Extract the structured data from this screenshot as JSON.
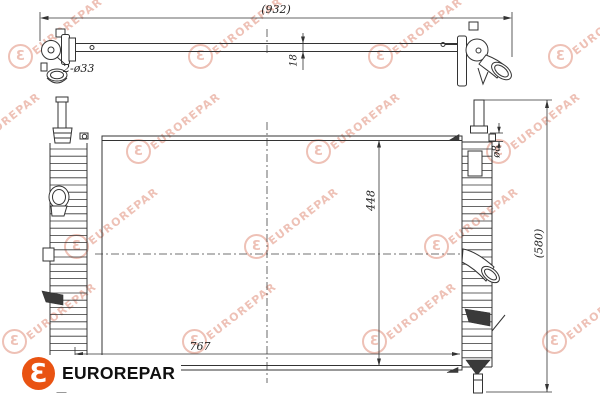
{
  "drawing": {
    "title": "radiator-technical-drawing",
    "line_color": "#333333",
    "dimensions": {
      "overall_width": "(932)",
      "core_thickness": "18",
      "inlet_ports": "2-ø33",
      "core_height": "448",
      "bleed_port": "ø8",
      "overall_height": "(580)",
      "core_width": "767"
    }
  },
  "watermark": {
    "text": "EUROREPAR",
    "logo_letter": "Ɛ",
    "color": "#eec1b6"
  },
  "brand": {
    "name": "EUROREPAR",
    "logo_letter": "Ɛ",
    "logo_color": "#e95312",
    "text_color": "#101010"
  }
}
